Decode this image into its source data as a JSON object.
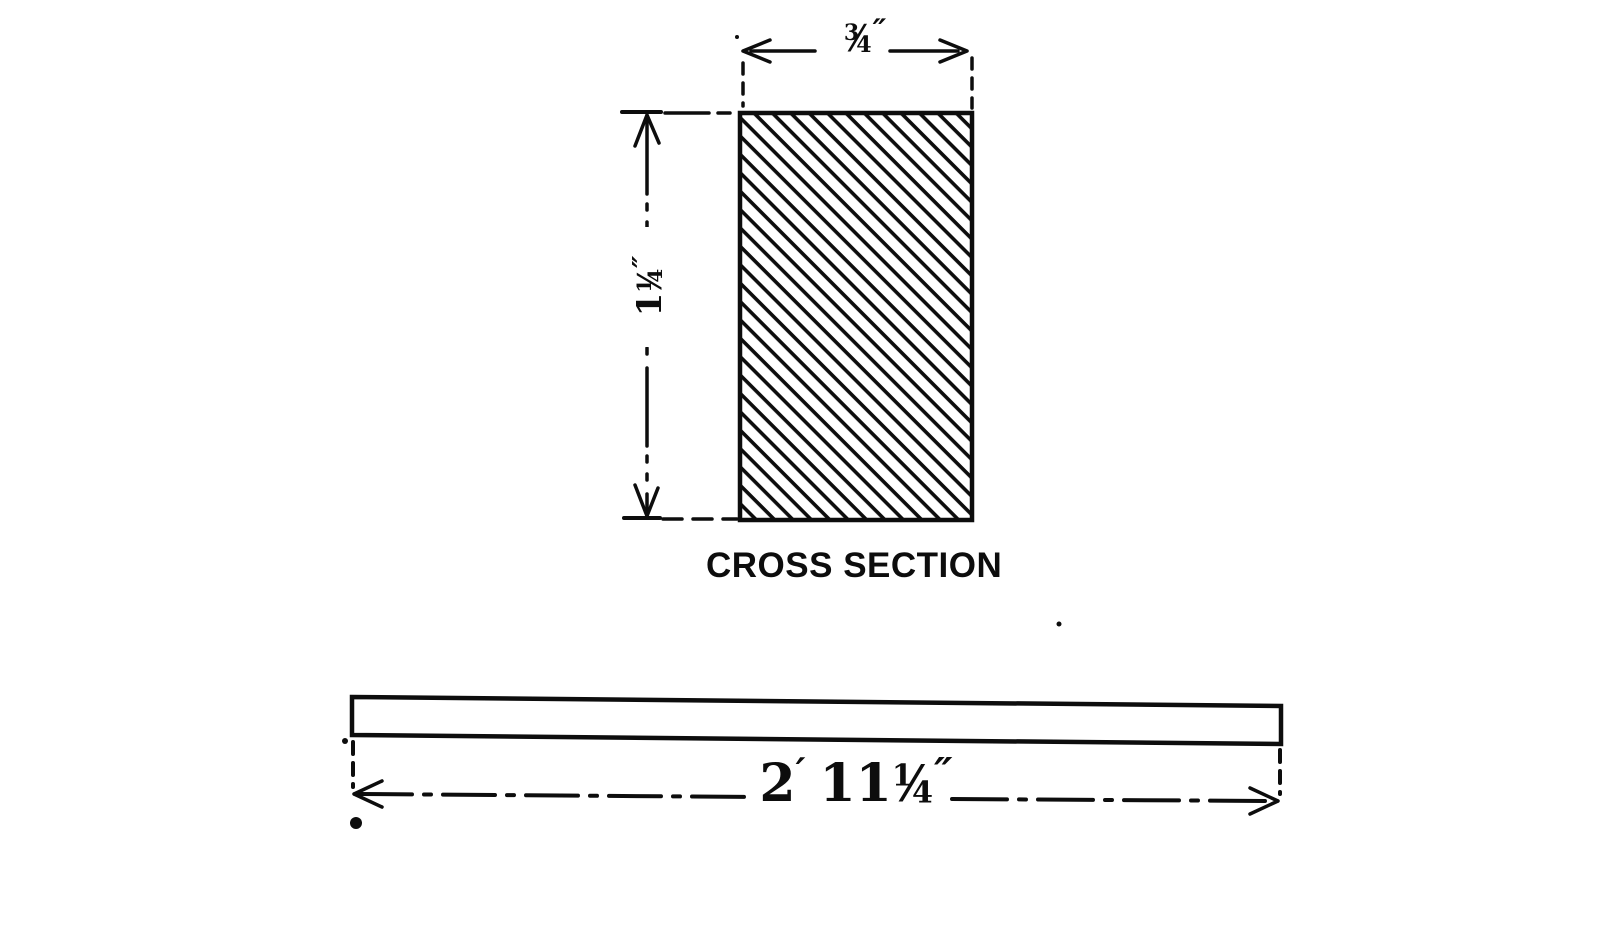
{
  "colors": {
    "ink": "#0d0d0d",
    "paper": "#ffffff"
  },
  "glyphs": {
    "fraction_slash": "⁄"
  },
  "cross_section": {
    "caption": "CROSS SECTION",
    "width_dim": {
      "numerator": "3",
      "denominator": "4",
      "unit": "″"
    },
    "height_dim": {
      "whole": "1",
      "numerator": "1",
      "denominator": "4",
      "unit": "″"
    }
  },
  "bar": {
    "length_dim": {
      "feet": "2",
      "feet_mark": "′",
      "inches": "11",
      "numerator": "1",
      "denominator": "4",
      "unit": "″"
    }
  }
}
